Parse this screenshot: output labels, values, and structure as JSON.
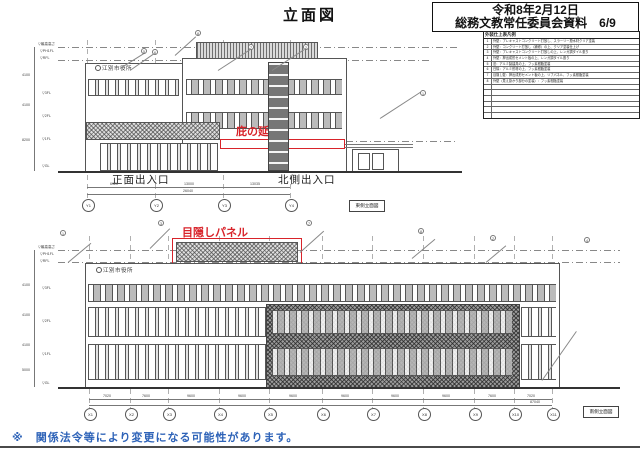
{
  "title": "立面図",
  "header": {
    "line1": "令和8年2月12日",
    "line2": "総務文教常任委員会資料　6/9"
  },
  "legend": {
    "title": "外装仕上表凡例",
    "rows": [
      {
        "no": "1",
        "text": "外壁：プレキャストコンクリート打放し、スラーリー撥水材クリア塗装"
      },
      {
        "no": "2",
        "text": "外壁：コンクリート打放し（補修）の上、クリア塗装仕上げ"
      },
      {
        "no": "3",
        "text": "外壁：プレキャストコンクリート打放しの上、レンガ調タイル張り"
      },
      {
        "no": "4",
        "text": "外壁：押出成形セメント板の上、レンガ調タイル張り"
      },
      {
        "no": "5",
        "text": "窓：アルミ製建具の上、フッ素樹脂塗装"
      },
      {
        "no": "6",
        "text": "日除：アルミ形材の上、フッ素樹脂塗装"
      },
      {
        "no": "7",
        "text": "目隠し壁：押出成形セメント板の上、リブパネル、フッ素樹脂塗装"
      },
      {
        "no": "8",
        "text": "外壁（見え掛かり部分の塗装）：フッ素樹脂塗装"
      }
    ]
  },
  "east": {
    "caption": "東側立面図",
    "sign": "江別市役所",
    "canopy_label": "庇の延長",
    "entrance_label": "正面出入口",
    "north_entrance_label": "北側出入口",
    "levels": [
      "▽最高高さ",
      "▽PH1FL",
      "▽RFL",
      "▽3FL",
      "▽2FL",
      "▽1FL",
      "▽GL"
    ],
    "axes": [
      "Y1",
      "Y2",
      "Y3",
      "Y4"
    ],
    "dims": [
      "6920",
      "13000",
      "13035"
    ],
    "total_dim": "26040",
    "vdims": [
      "4100",
      "4100",
      "8200"
    ],
    "callouts": [
      "5",
      "6",
      "8",
      "7",
      "2",
      "1"
    ]
  },
  "south": {
    "caption": "南側立面図",
    "sign": "江別市役所",
    "panel_label": "目隠しパネル",
    "levels": [
      "▽最高高さ",
      "▽PH1FL",
      "▽RFL",
      "▽3FL",
      "▽2FL",
      "▽1FL",
      "▽GL"
    ],
    "axes": [
      "X1",
      "X2",
      "X3",
      "X4",
      "X5",
      "X6",
      "X7",
      "X8",
      "X9",
      "X10",
      "X11"
    ],
    "dims": [
      "7020",
      "7600",
      "9600",
      "9600",
      "9600",
      "9600",
      "9600",
      "9600",
      "7600",
      "7020"
    ],
    "total_dim": "87040",
    "vdims": [
      "4100",
      "4100",
      "4100",
      "5000"
    ],
    "callouts": [
      "1",
      "3",
      "7",
      "8",
      "2",
      "4"
    ]
  },
  "note": "※　関係法令等により変更になる可能性があります。",
  "colors": {
    "red": "#d8232a",
    "blue": "#2e63b8"
  }
}
